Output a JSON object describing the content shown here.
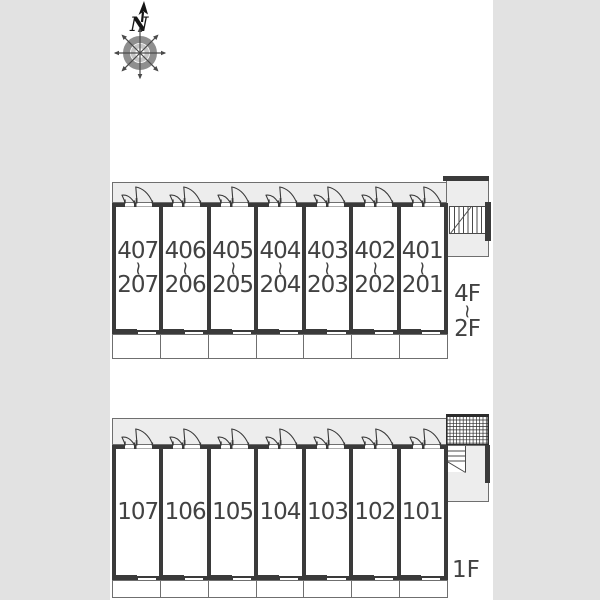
{
  "compass": {
    "north_label": "N"
  },
  "upper_building": {
    "floor_range": {
      "top": "4F",
      "separator": "~",
      "bottom": "2F"
    },
    "units": [
      {
        "upper": "407",
        "separator": "~",
        "lower": "207"
      },
      {
        "upper": "406",
        "separator": "~",
        "lower": "206"
      },
      {
        "upper": "405",
        "separator": "~",
        "lower": "205"
      },
      {
        "upper": "404",
        "separator": "~",
        "lower": "204"
      },
      {
        "upper": "403",
        "separator": "~",
        "lower": "203"
      },
      {
        "upper": "402",
        "separator": "~",
        "lower": "202"
      },
      {
        "upper": "401",
        "separator": "~",
        "lower": "201"
      }
    ]
  },
  "lower_building": {
    "floor_label": "1F",
    "units": [
      {
        "label": "107"
      },
      {
        "label": "106"
      },
      {
        "label": "105"
      },
      {
        "label": "104"
      },
      {
        "label": "103"
      },
      {
        "label": "102"
      },
      {
        "label": "101"
      }
    ]
  },
  "colors": {
    "margin": "#e2e2e2",
    "paper": "#ffffff",
    "wall": "#3a3a3a",
    "corridor": "#ededed",
    "thin_line": "#6f6f6f",
    "text": "#424242"
  }
}
